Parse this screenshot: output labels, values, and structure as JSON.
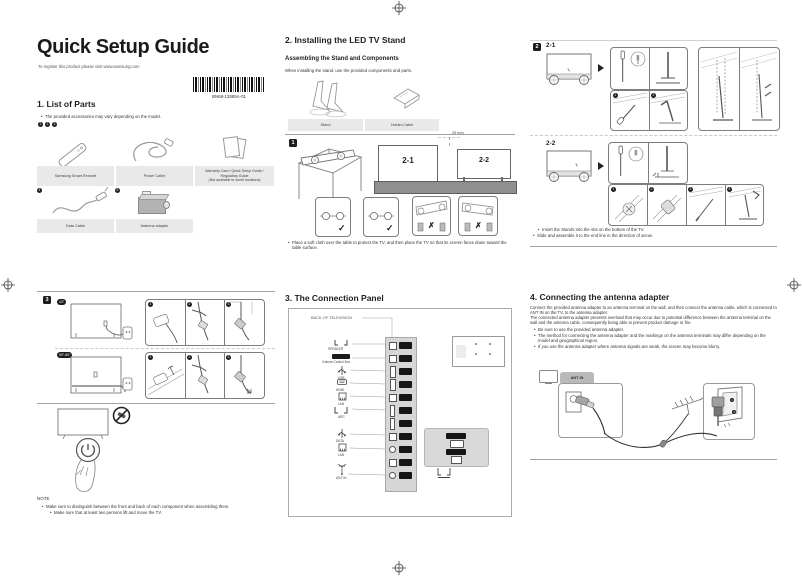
{
  "doc": {
    "title": "Quick Setup Guide",
    "subtitle": "To register this product please visit www.samsung.com",
    "barcode": "BN68-12885A-01"
  },
  "parts": {
    "heading": "1. List of Parts",
    "note": "The provided accessories may vary depending on the model.",
    "row1_badges": [
      "1",
      "2",
      "3"
    ],
    "row1_labels": [
      "Samsung Smart Remote",
      "Power Cable"
    ],
    "warranty_lines": [
      "Warranty Card / Quick Setup Guide /",
      "Regulatory Guide",
      "(Not available in some locations)"
    ],
    "row2_badges": [
      "4",
      "5"
    ],
    "row2_labels": [
      "Data Cable",
      "Antenna adapter"
    ]
  },
  "stand": {
    "heading": "2. Installing the LED TV Stand",
    "subheading": "Assembling the Stand and Components",
    "intro": "When installing the stand, use the provided components and parts.",
    "part_labels": [
      "Stand",
      "Holder-Cable"
    ],
    "step1_badge": "1",
    "model_a": "2-1",
    "model_b": "2-2",
    "measure": "25 mm",
    "marks": [
      "✓",
      "✓",
      "✗",
      "✗"
    ],
    "bullet": "Place a soft cloth over the table to protect the TV, and then place the TV so that its screen faces down toward the table surface.",
    "step2_badge": "2",
    "detail_badges_21": [
      "1",
      "2"
    ],
    "detail_badges_22": [
      "1",
      "2",
      "3",
      "4"
    ],
    "bullets_22": [
      "Insert the Stands into the slot on the bottom of the TV.",
      "Slide and assemble it to the end line in the direction of arrow."
    ],
    "step3_badge": "3",
    "size_small": "43\"",
    "size_large": "50\"-85\"",
    "cable_badges": [
      "1",
      "2",
      "3"
    ],
    "note_heading": "NOTE",
    "notes": [
      "Make sure to distinguish between the front and back of each component when assembling them.",
      "Make sure that at least two persons lift and move the TV."
    ]
  },
  "panel": {
    "heading": "3. The Connection Panel",
    "back_label": "BACK OF TELEVISION",
    "port_labels": [
      "SPEAKER",
      "Volume Control Box",
      "USB",
      "HDMI",
      "LAN",
      "ARC",
      "DATA",
      "LAN",
      "ANT IN"
    ]
  },
  "antenna": {
    "heading": "4. Connecting the antenna adapter",
    "para1": "Connect the provided antenna adapter to an antenna terminal on the wall, and then connect the antenna cable, which is connected to ANT IN on the TV, to the antenna adapter.",
    "para2": "The connected antenna adapter prevents overload that may occur due to potential difference between the antenna terminal on the wall and the antenna cable, consequently being able to prevent product damage or fire.",
    "bullets": [
      "Be sure to use the provided antenna adapter.",
      "The method for connecting the antenna adapter and the markings on the antenna terminals may differ depending on the model and geographical region.",
      "If you use the antenna adapter where antenna signals are weak, the screen may become blurry."
    ],
    "tab_label": "ANT IN",
    "step_badges": [
      "1",
      "2"
    ]
  }
}
